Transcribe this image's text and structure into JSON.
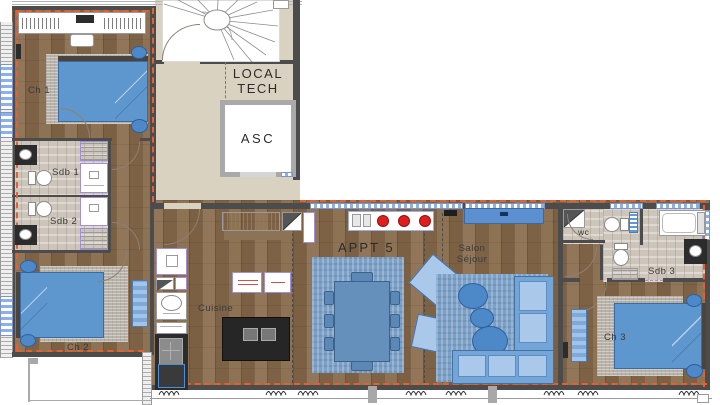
{
  "rooms": {
    "ch1": "Ch 1",
    "sdb1": "Sdb 1",
    "sdb2": "Sdb 2",
    "ch2": "Ch 2",
    "cuisine": "Cuisine",
    "appt5": "APPT 5",
    "salon_line1": "Salon",
    "salon_line2": "Séjour",
    "wc": "wc",
    "sdb3": "Sdb 3",
    "ch3": "Ch 3",
    "local_tech_line1": "LOCAL",
    "local_tech_line2": "TECH",
    "asc": "ASC"
  },
  "colors": {
    "wood": "#8a6d4f",
    "beige": "#d9d2c1",
    "tile": "#cdc5ba",
    "wall": "#4c4c4c",
    "insulation_orange": "#e85f2d",
    "window_blue": "#8cb0e8",
    "furniture_blue": "#5e97cd",
    "furniture_blue_light": "#8fb8e2",
    "rug_blue": "#7ba1c8",
    "rug_grey": "#b8b2a9",
    "sofa_blue": "#74a5d8",
    "sofa_blue_light": "#a9c8ea",
    "counter_dark": "#2c2c2c",
    "burner_red": "#e11e1e",
    "accent_purple": "#9f8fd6",
    "pouf_blue": "#4d89c9",
    "shelf_brown": "#8d7355"
  }
}
